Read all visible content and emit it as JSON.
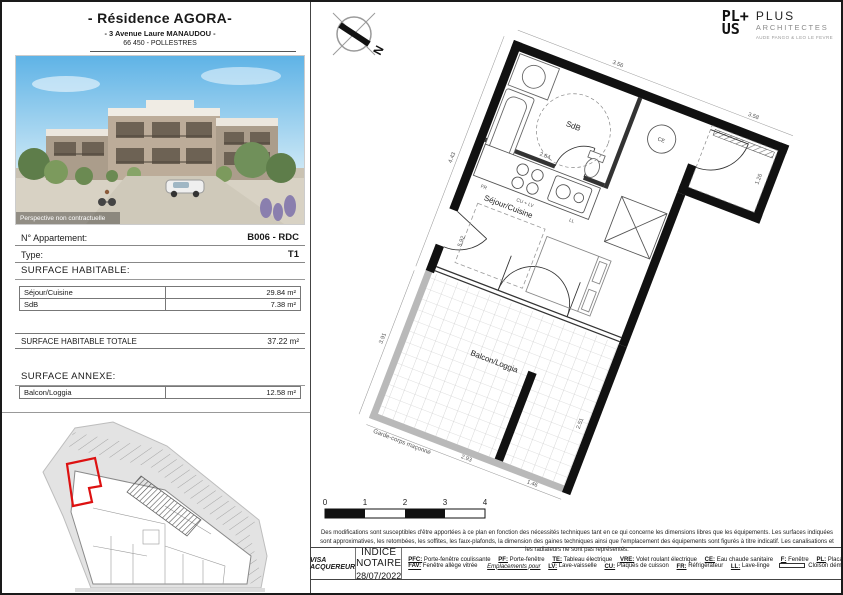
{
  "header": {
    "title": "- Résidence AGORA-",
    "address": "- 3 Avenue Laure MANAUDOU -",
    "city": "66 450 - POLLESTRES"
  },
  "photo": {
    "caption": "Perspective non contractuelle"
  },
  "info": {
    "apartment_label": "N° Appartement:",
    "apartment_value": "B006 - RDC",
    "type_label": "Type:",
    "type_value": "T1"
  },
  "surface_habitable": {
    "heading": "SURFACE HABITABLE:",
    "rows": [
      {
        "label": "Séjour/Cuisine",
        "value": "29.84 m²"
      },
      {
        "label": "SdB",
        "value": "7.38 m²"
      }
    ],
    "total_label": "SURFACE HABITABLE TOTALE",
    "total_value": "37.22 m²"
  },
  "surface_annexe": {
    "heading": "SURFACE ANNEXE:",
    "rows": [
      {
        "label": "Balcon/Loggia",
        "value": "12.58 m²"
      }
    ]
  },
  "logo": {
    "mark_line1": "PL+",
    "mark_line2": "US",
    "name": "PLUS",
    "subtitle": "ARCHITECTES",
    "tagline": "AUDE PANGO & LEO LE FEVRE"
  },
  "compass": {
    "north": "N"
  },
  "plan": {
    "rooms": {
      "sdb": "SdB",
      "sejour": "Séjour/Cuisine",
      "balcon": "Balcon/Loggia"
    },
    "annotations": {
      "garde_corps": "Garde-corps maçonné"
    },
    "appliances": {
      "fr": "FR",
      "cu_lv": "CU + LV",
      "ll": "LL",
      "ce": "CE"
    },
    "dimensions": [
      "3.56",
      "3.58",
      "4.43",
      "5.92",
      "2.64",
      "1.26",
      "3.91",
      "2.93",
      "2.51",
      "1.46"
    ]
  },
  "scale_bar": {
    "ticks": [
      "0",
      "1",
      "2",
      "3",
      "4"
    ]
  },
  "disclaimer": "Des modifications sont susceptibles d'être apportées à ce plan en fonction des nécessités techniques tant en ce qui concerne les dimensions libres que les équipements. Les surfaces indiquées sont approximatives, les retombées, les soffites, les faux-plafonds, la dimension des gaines techniques ainsi que l'emplacement des équipements sont figurés à titre indicatif. Les canalisations et les radiateurs ne sont pas représentés.",
  "footer": {
    "visa": "VISA ACQUEREUR",
    "indice_label": "INDICE NOTAIRE",
    "indice_date": "28/07/2022",
    "legend_row1": [
      {
        "key": "PFC:",
        "label": "Porte-fenêtre coulissante"
      },
      {
        "key": "PF:",
        "label": "Porte-fenêtre"
      },
      {
        "key": "TE:",
        "label": "Tableau électrique"
      },
      {
        "key": "VRE:",
        "label": "Volet roulant électrique"
      },
      {
        "key": "CE:",
        "label": "Eau chaude sanitaire"
      },
      {
        "key": "F:",
        "label": "Fenêtre"
      },
      {
        "key": "PL:",
        "label": "Placard"
      }
    ],
    "legend_row2_intro": {
      "key": "FAV:",
      "label": "Fenêtre allège vitrée"
    },
    "legend_row2_heading": "Emplacements pour",
    "legend_row2": [
      {
        "key": "LV:",
        "label": "Lave-vaisselle"
      },
      {
        "key": "CU:",
        "label": "Plaques de cuisson"
      },
      {
        "key": "FR:",
        "label": "Réfrigérateur"
      },
      {
        "key": "LL:",
        "label": "Lave-linge"
      }
    ],
    "cloison_label": "Cloison démontable"
  },
  "colors": {
    "accent_red": "#dd1111",
    "wall_black": "#111111",
    "site_gray": "#e3e3e3"
  }
}
